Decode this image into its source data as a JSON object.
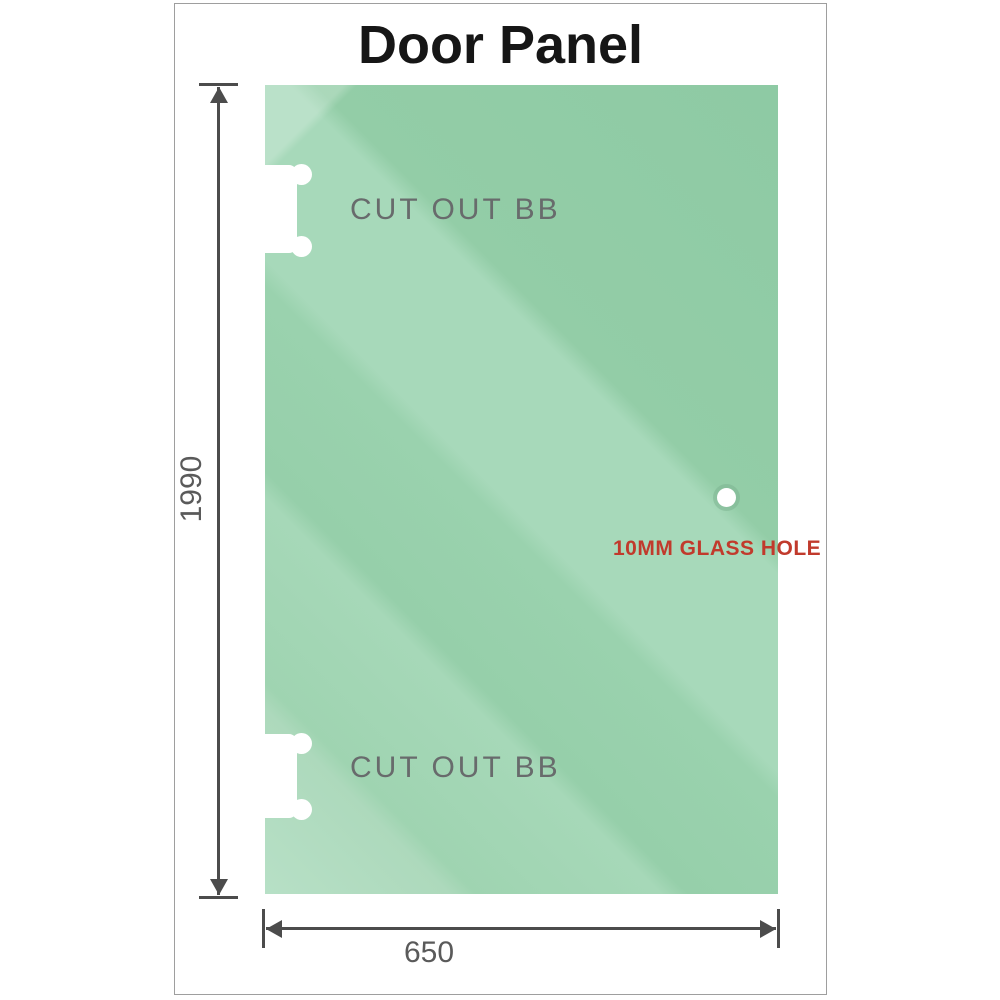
{
  "title": "Door Panel",
  "panel": {
    "cutout_top_label": "CUT OUT BB",
    "cutout_bottom_label": "CUT OUT BB",
    "hole_label": "10MM GLASS HOLE"
  },
  "dimensions": {
    "height_label": "1990",
    "width_label": "650"
  },
  "colors": {
    "glass-base": "#8ecaa4",
    "glass-light": "#a7d9ba",
    "glass-lightest": "#b7e0c6",
    "dimension-line": "#4c4c4c",
    "dimension-text": "#5a5a5a",
    "cutout-text": "#686b6c",
    "hole-label-red": "#c13a2c",
    "title-color": "#161616",
    "frame-border": "#9e9e9e"
  }
}
